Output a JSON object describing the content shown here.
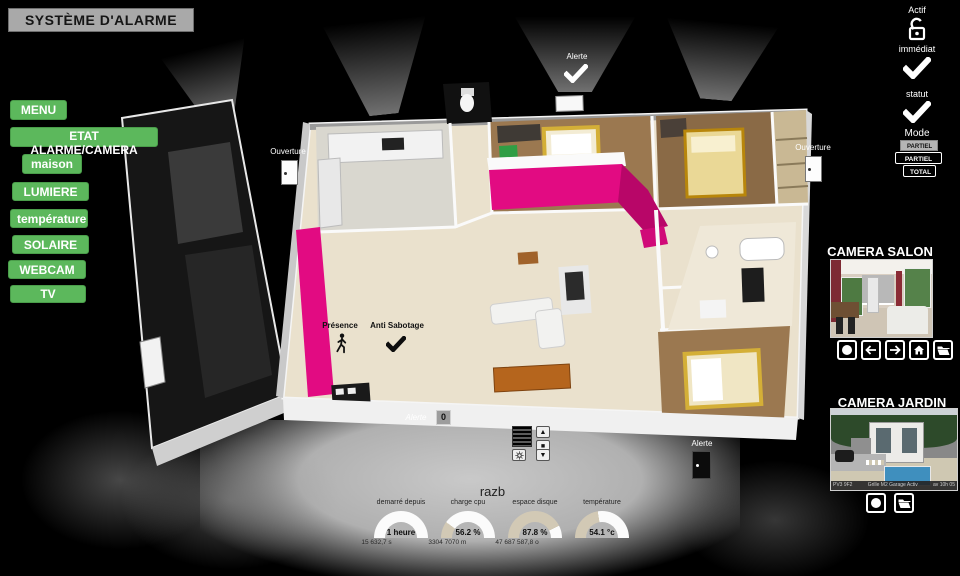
{
  "window": {
    "title": "SYSTÈME D'ALARME"
  },
  "menu": {
    "items": [
      {
        "label": "MENU"
      },
      {
        "label": "ETAT ALARME/CAMERA"
      },
      {
        "label": "maison"
      },
      {
        "label": "LUMIERE"
      },
      {
        "label": "température"
      },
      {
        "label": "SOLAIRE"
      },
      {
        "label": "WEBCAM"
      },
      {
        "label": "TV"
      }
    ]
  },
  "alarm": {
    "actif_label": "Actif",
    "lock_icon": "padlock-open-icon",
    "immediat_label": "immédiat",
    "immediat_state_icon": "checkmark-icon",
    "statut_label": "statut",
    "statut_state_icon": "checkmark-icon",
    "mode_label": "Mode",
    "modes": [
      {
        "label": "PARTIEL NUIT",
        "selected": true
      },
      {
        "label": "PARTIEL NUIT",
        "selected": false
      },
      {
        "label": "TOTAL",
        "selected": false
      }
    ]
  },
  "plan": {
    "ouverture_left": "Ouverture",
    "ouverture_right": "Ouverture",
    "alerte_top": "Alerte",
    "presence_label": "Présence",
    "presence_icon": "walking-person-icon",
    "anti_sabotage_label": "Anti Sabotage",
    "anti_sabotage_icon": "checkmark-icon",
    "alerte_shutter_label": "Alerte",
    "alerte_shutter_count": "0",
    "alerte_door_label": "Alerte",
    "shutter_control_icons": [
      "arrow-up",
      "stop-square",
      "sun",
      "arrow-down"
    ]
  },
  "cameras": {
    "salon": {
      "title": "CAMERA SALON",
      "button_icons": [
        "record-circle",
        "arrow-left",
        "arrow-right",
        "home",
        "folder"
      ]
    },
    "jardin": {
      "title": "CAMERA JARDIN",
      "status_left": "PV3 9F2",
      "status_center": "Grille M2 Garage Activ",
      "status_right": "av 10h 05",
      "button_icons": [
        "record-circle",
        "folder"
      ]
    }
  },
  "system": {
    "hostname": "razb",
    "gauges": [
      {
        "label": "demarré depuis",
        "value": "1 heure",
        "sub": "15 632,7 s",
        "dark_pct": 0
      },
      {
        "label": "charge cpu",
        "value": "56.2 %",
        "sub": "3304 7070 m",
        "dark_pct": 20
      },
      {
        "label": "espace disque",
        "value": "87.8 %",
        "sub": "47 687 587,8 o",
        "dark_pct": 85
      },
      {
        "label": "température",
        "value": "54.1 °c",
        "sub": "",
        "dark_pct": 45
      }
    ]
  },
  "colors": {
    "menu_green": "#5cb85c",
    "accent_magenta": "#e20b82",
    "check_white": "#ffffff",
    "background": "#000000"
  }
}
